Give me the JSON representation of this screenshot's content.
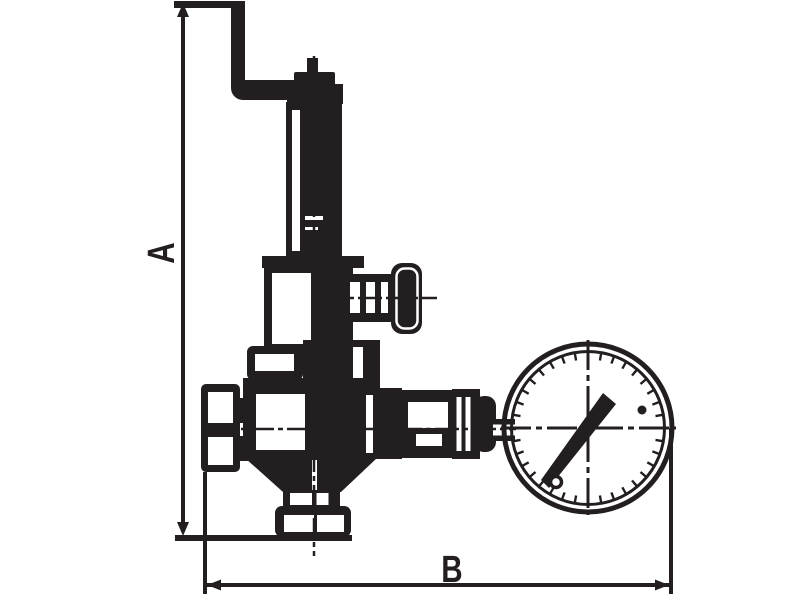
{
  "diagram": {
    "kind": "technical-line-drawing",
    "subject": "relief valve with test lever and pressure gauge, dimensioned outline drawing",
    "colors": {
      "line": "#231f20",
      "background": "#ffffff"
    },
    "dimension_labels": {
      "height": "A",
      "width": "B"
    },
    "parts": [
      "test-lever",
      "stem-tip",
      "adjustment-cap",
      "spring-housing",
      "hex-adapter",
      "bonnet-block",
      "side-spindle-handle",
      "body-flange",
      "valve-body",
      "inlet-union",
      "outlet-coupling",
      "ribbed-coupling",
      "gauge-connector",
      "pressure-gauge",
      "gauge-needle",
      "bottom-outlet-flange"
    ]
  }
}
